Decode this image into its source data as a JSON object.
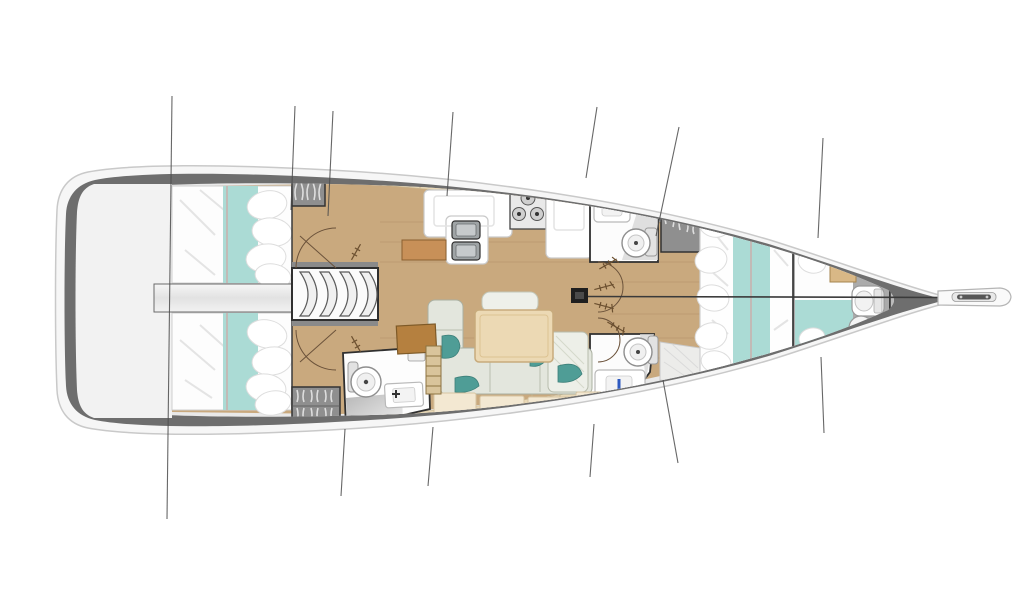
{
  "meta": {
    "description": "Top-down interior layout plan of a sailing monohull yacht, bow pointing right, stern swim platform on the left. Purely graphical drawing with no visible text labels.",
    "canvas": {
      "width": 1024,
      "height": 600
    },
    "background": "#ffffff"
  },
  "palette": {
    "hull_band": "#6e6e6e",
    "hull_outer": "#f4f4f4",
    "deck_platform": "#f2f2f2",
    "interior_deck": "#e9e9e9",
    "floor_wood": "#c9a97e",
    "deck_trim_wood": "#e9d8b6",
    "bedding_white": "#fdfdfd",
    "bedding_teal": "#abdbd5",
    "seam_pink": "#d89a96",
    "pillow_teal": "#4f9d96",
    "sofa_sage": "#e3e6dd",
    "table_wood": "#ecd9b4",
    "chart_table_brown": "#b5803f",
    "wardrobe_grey": "#8f8f8f",
    "fixture_white": "#ffffff",
    "rig_line": "#4c4c4c"
  },
  "rooms": {
    "transom": {
      "label": "Transom swim platform"
    },
    "walkway": {
      "label": "Central walkway between aft cabins"
    },
    "aft_cabin_port": {
      "label": "Aft double cabin, port (top)"
    },
    "aft_cabin_starboard": {
      "label": "Aft double cabin, starboard (bottom)"
    },
    "companionway": {
      "label": "Companionway with four curved steps"
    },
    "galley": {
      "label": "Galley with twin sinks and three-burner stove"
    },
    "head_fwd_top": {
      "label": "Head with sink and toilet (top, forward of galley)"
    },
    "head_aft_bottom_left": {
      "label": "Head with toilet, sink and shower (bottom left)"
    },
    "head_fwd_bottom": {
      "label": "Head with toilet and sink (bottom right of salon)"
    },
    "salon": {
      "label": "Salon with U-shaped settee and dining table"
    },
    "nav_station": {
      "label": "Chart table and seat"
    },
    "forward_cabin": {
      "label": "Forward cabin with island double berth"
    },
    "forepeak": {
      "label": "Forepeak berth with toilet"
    },
    "mast": {
      "label": "Mast with forestay and shroud rigging lines"
    },
    "bow_fitting": {
      "label": "Bow anchor roller sprit"
    },
    "wardrobes": {
      "label": "Hanging locker wardrobes"
    }
  }
}
